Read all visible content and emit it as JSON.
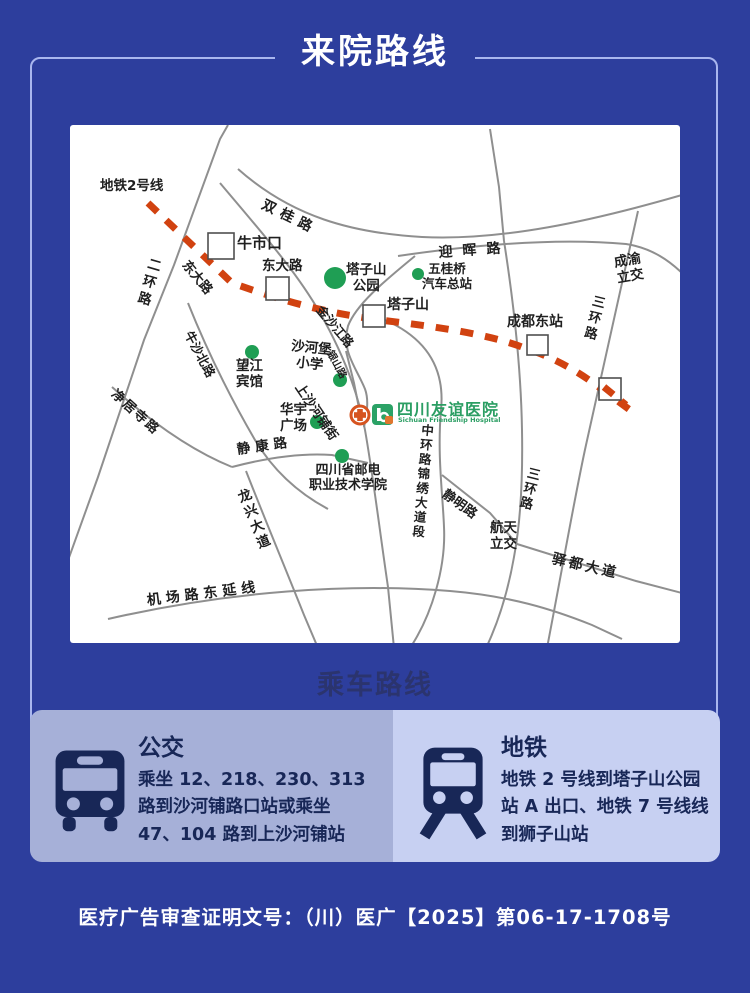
{
  "page": {
    "title": "来院路线",
    "heading": "乘车路线",
    "footer_license": "医疗广告审查证明文号：（川）医广【2025】第06-17-1708号"
  },
  "colors": {
    "background": "#2d3e9d",
    "frame_border": "#a9b6ee",
    "bus_card_bg": "#a6b0d8",
    "metro_card_bg": "#c7d0f2",
    "dark_navy": "#182757",
    "metro_line_red": "#d14210",
    "poi_green": "#1f9e54",
    "hospital_green": "#2b9e63"
  },
  "map": {
    "hospital": {
      "name": "四川友谊医院",
      "name_en": "Sichuan Friendship Hospital"
    },
    "labels": [
      {
        "id": "metro-line-2",
        "text": "地铁2号线"
      },
      {
        "id": "shuanggui-road",
        "text": "双桂路"
      },
      {
        "id": "niushikou-station",
        "text": "牛市口"
      },
      {
        "id": "yinghui-road",
        "text": "迎晖路"
      },
      {
        "id": "chengyu-interchange",
        "text": "成渝\n立交"
      },
      {
        "id": "erhuan-road",
        "text": "二环路"
      },
      {
        "id": "dongda-road-diagonal",
        "text": "东大路"
      },
      {
        "id": "dongda-road",
        "text": "东大路"
      },
      {
        "id": "tazishan-park",
        "text": "塔子山\n公园"
      },
      {
        "id": "wuguiqiao-bus-terminal",
        "text": "五桂桥\n汽车总站"
      },
      {
        "id": "tazishan-station",
        "text": "塔子山"
      },
      {
        "id": "chengdu-east-station",
        "text": "成都东站"
      },
      {
        "id": "sanhuan-road-north",
        "text": "三环路"
      },
      {
        "id": "jinshajiang-road",
        "text": "金沙江路"
      },
      {
        "id": "shahebao-primary-school",
        "text": "沙河堡\n小学"
      },
      {
        "id": "wangjiang-hotel",
        "text": "望江\n宾馆"
      },
      {
        "id": "niusha-north-road",
        "text": "牛沙北路"
      },
      {
        "id": "yinshan-road",
        "text": "银山路"
      },
      {
        "id": "shangshahepu-street",
        "text": "上沙河铺街"
      },
      {
        "id": "huayu-plaza",
        "text": "华宇\n广场"
      },
      {
        "id": "jingkang-road",
        "text": "静康路"
      },
      {
        "id": "post-telecom-college",
        "text": "四川省邮电\n职业技术学院"
      },
      {
        "id": "jingjusi-road",
        "text": "净居寺路"
      },
      {
        "id": "longxing-avenue",
        "text": "龙兴大道"
      },
      {
        "id": "airport-road-east-ext",
        "text": "机场路东延线"
      },
      {
        "id": "zhonghuan-jinxiu-section",
        "text": "中环路锦绣大道段"
      },
      {
        "id": "jingming-road",
        "text": "静明路"
      },
      {
        "id": "sanhuan-road-south",
        "text": "三环路"
      },
      {
        "id": "hangtian-interchange",
        "text": "航天\n立交"
      },
      {
        "id": "yidu-avenue",
        "text": "驿都大道"
      }
    ]
  },
  "transit": {
    "bus": {
      "icon": "bus-front-icon",
      "title": "公交",
      "desc": "乘坐 12、218、230、313 路到沙河铺路口站或乘坐 47、104 路到上沙河铺站"
    },
    "metro": {
      "icon": "train-front-icon",
      "title": "地铁",
      "desc": "地铁 2 号线到塔子山公园站 A 出口、地铁 7 号线线到狮子山站"
    }
  }
}
